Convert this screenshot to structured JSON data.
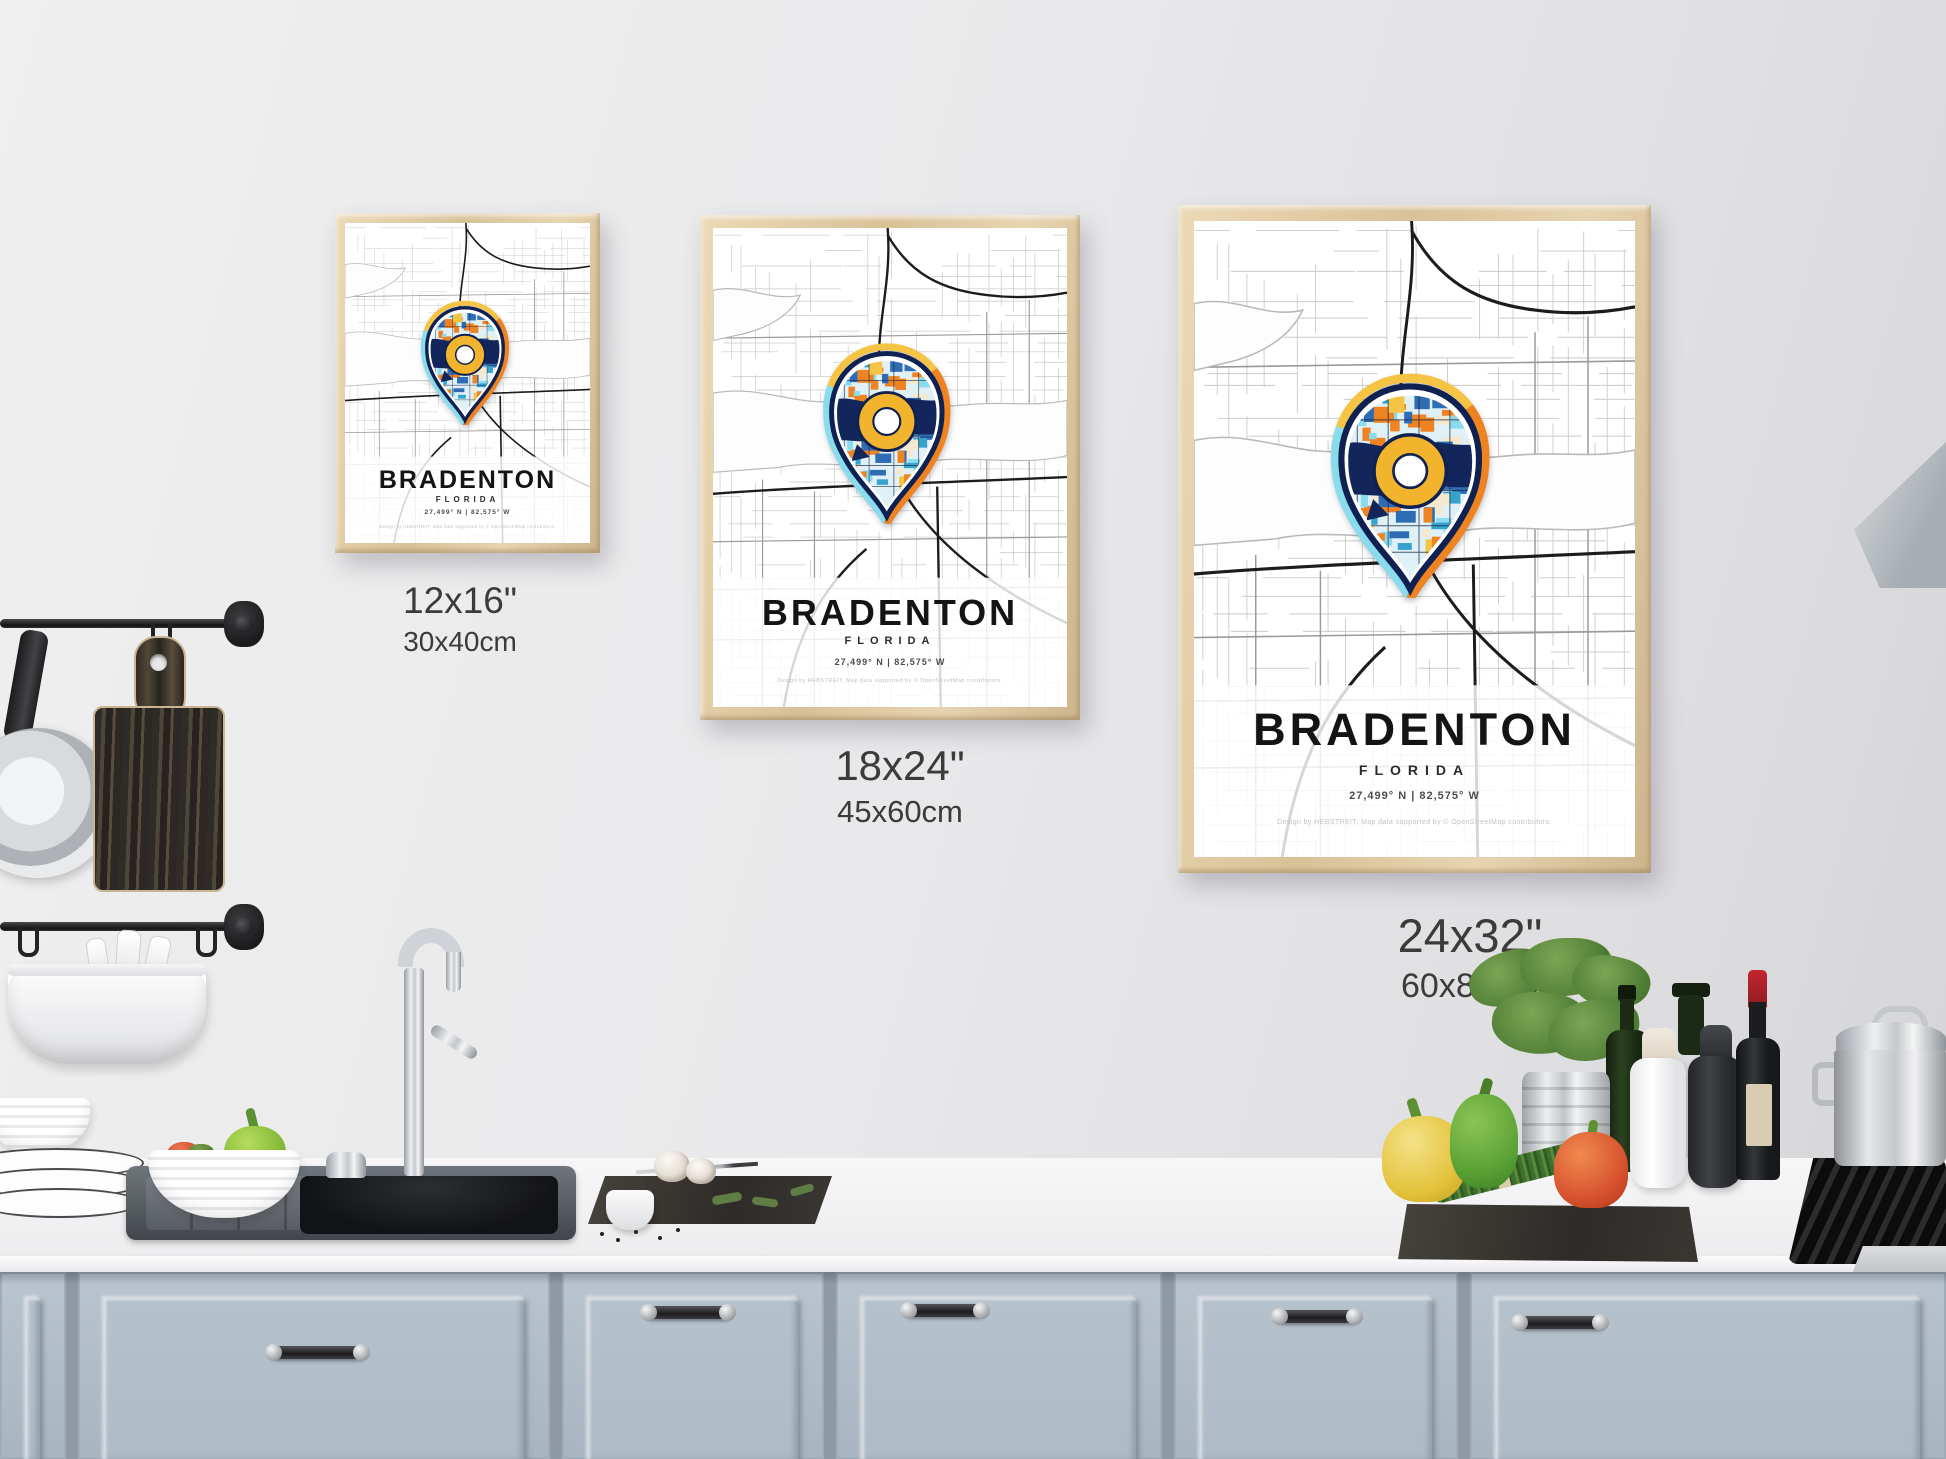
{
  "posters": [
    {
      "city": "BRADENTON",
      "region": "FLORIDA",
      "coordinates": "27,499° N | 82,575° W",
      "credit": "Design by HEBSTREIT. Map data supported by © OpenStreetMap contributors.",
      "size_in": "12x16\"",
      "size_cm": "30x40cm"
    },
    {
      "city": "BRADENTON",
      "region": "FLORIDA",
      "coordinates": "27,499° N | 82,575° W",
      "credit": "Design by HEBSTREIT. Map data supported by © OpenStreetMap contributors.",
      "size_in": "18x24\"",
      "size_cm": "45x60cm"
    },
    {
      "city": "BRADENTON",
      "region": "FLORIDA",
      "coordinates": "27,499° N | 82,575° W",
      "credit": "Design by HEBSTREIT. Map data supported by © OpenStreetMap contributors.",
      "size_in": "24x32\"",
      "size_cm": "60x80cm"
    }
  ],
  "colors": {
    "wall": "#e9e9eb",
    "frame_wood": "#e2cda9",
    "cabinet": "#b3bfc9",
    "pin_navy": "#13265c",
    "pin_outline": "#0e2150",
    "pin_orange": "#ef8322",
    "pin_yellow": "#f6c445",
    "pin_cyan": "#8adced",
    "pin_blue": "#2e6db4",
    "pin_cream": "#f3e9cf",
    "donut_yellow": "#f3b42d",
    "map_road_dark": "#1c1c1c",
    "map_road_light": "#c9c9c9"
  }
}
